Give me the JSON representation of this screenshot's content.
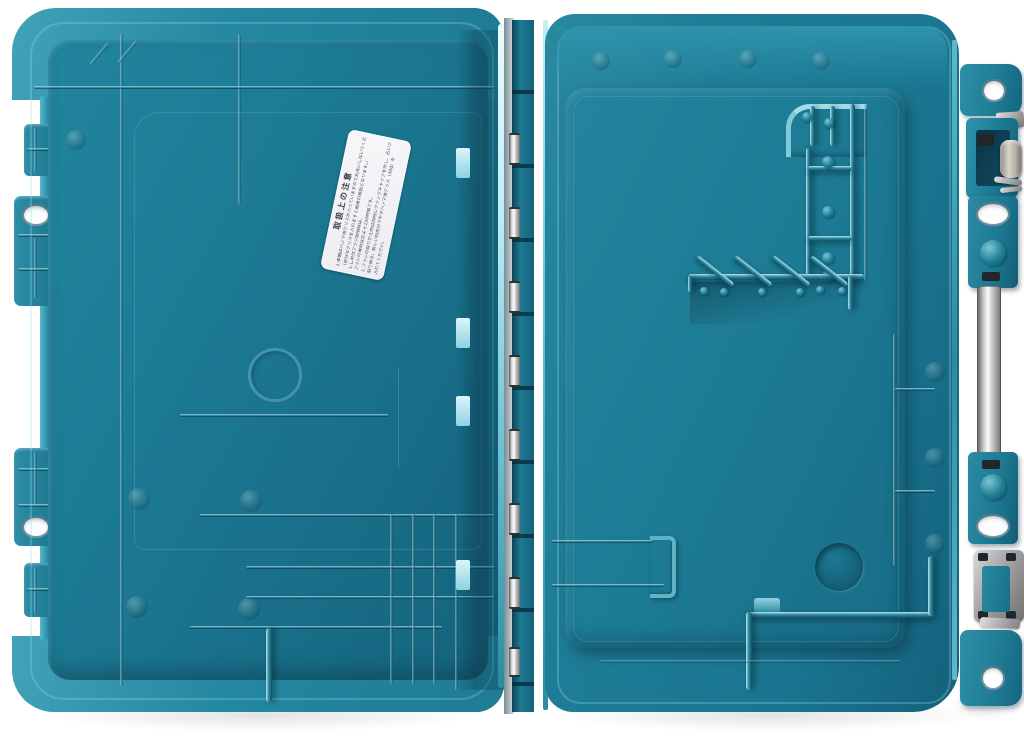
{
  "meta": {
    "description": "Top-down photograph of an open teal plastic power-tool carrying case (lid interior on the left, case bottom interior on the right), joined by a piano hinge with metal pins, metal latches and a metal rod on the right edge, on a white background.",
    "background_color": "#ffffff"
  },
  "palette": {
    "teal_highlight": "#bfeef7",
    "teal_light": "#41a2b8",
    "teal_mid": "#1d7a93",
    "teal_deep": "#135c75",
    "teal_shadow": "#0a3b4e",
    "metal_light": "#f2f2f2",
    "metal_mid": "#b3b3b3",
    "metal_dark": "#6e6e6e",
    "roller_grey": "#b7b1a8",
    "label_background": "#f3f4f6",
    "label_text_color": "#3f3f4a"
  },
  "case": {
    "lid": {
      "part": "lid-interior-left-half",
      "tabs": 4,
      "oval_holes": 2
    },
    "base": {
      "part": "bottom-interior-right-half",
      "bit_holder_fins": 4
    },
    "hinge": {
      "pin_count": 8
    },
    "hardware": {
      "top_latch": "metal latch with roller",
      "bottom_latch": "metal latch plate",
      "rod": "chrome handle rod",
      "corner_holes": 2
    }
  },
  "label": {
    "title": "取扱上の注意",
    "lines": [
      "1.本機はハンマ用グリスが入っていますので丸洗いしないでください。",
      "（余分なグリスを入れますと故障の原因となります。）",
      "1.しめ付ブラシ使用時は、",
      "ブラシの寿命はおよそ150時間です。",
      "1.ブラシの取りかえ時は同時にクランクキャップを外し、古いグリスを",
      "取り除き、新しい別売のマキタハンマ用グリス（30g）を",
      "入れてください。"
    ]
  }
}
